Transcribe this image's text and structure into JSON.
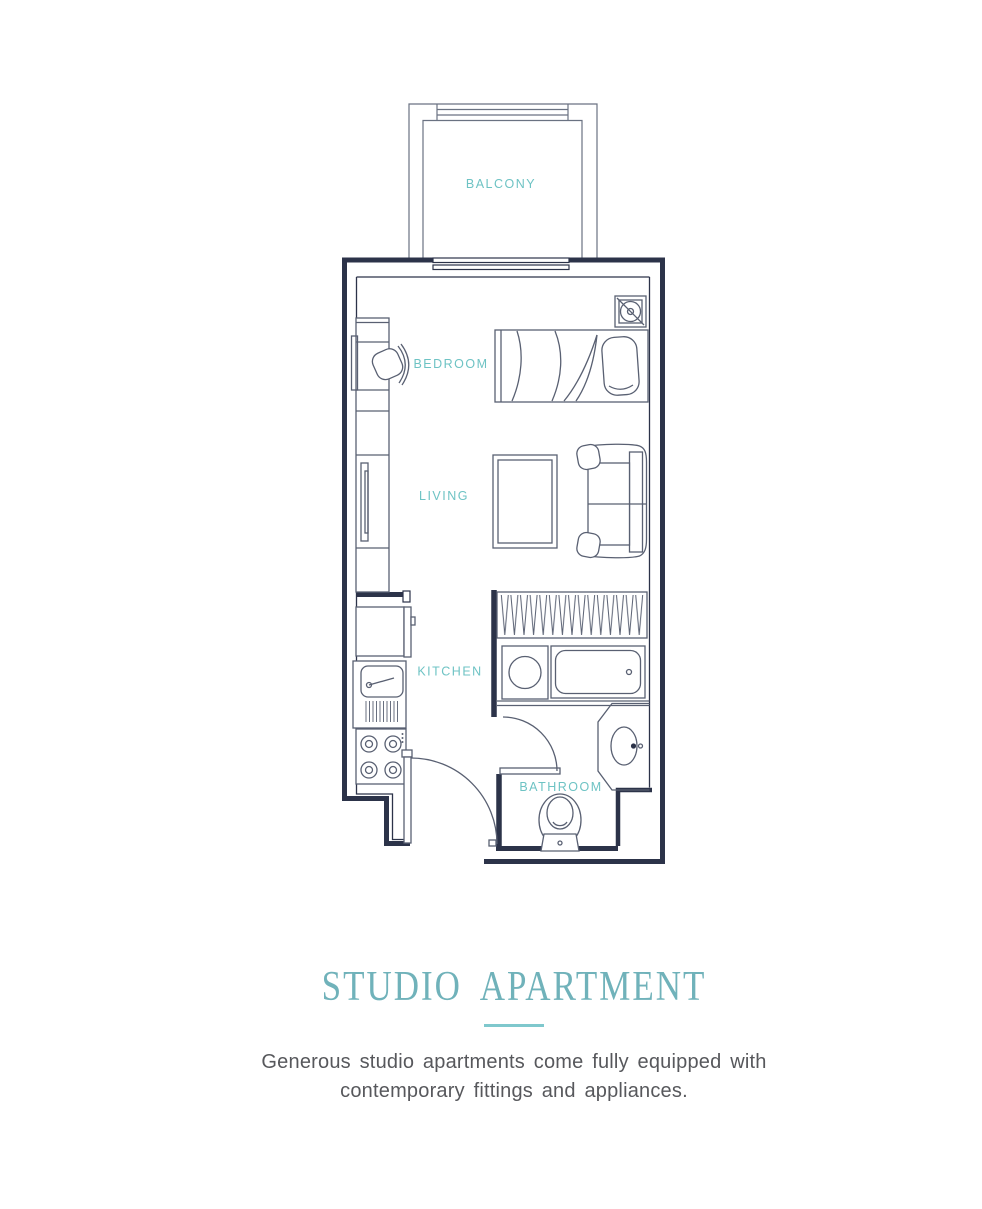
{
  "floor_plan": {
    "rooms": [
      {
        "id": "balcony",
        "label": "BALCONY"
      },
      {
        "id": "bedroom",
        "label": "BEDROOM"
      },
      {
        "id": "living",
        "label": "LIVING"
      },
      {
        "id": "kitchen",
        "label": "KITCHEN"
      },
      {
        "id": "bathroom",
        "label": "BATHROOM"
      }
    ],
    "colors": {
      "wall": "#2c3349",
      "furniture_line": "#596072",
      "balcony_line": "#6a7282",
      "room_label": "#6ec3c4"
    }
  },
  "caption": {
    "title": "STUDIO APARTMENT",
    "title_color": "#70b2ba",
    "divider_color": "#7fc8cd",
    "text_color": "#57585c",
    "description_line1": "Generous studio apartments come fully equipped with",
    "description_line2": "contemporary fittings and appliances."
  }
}
